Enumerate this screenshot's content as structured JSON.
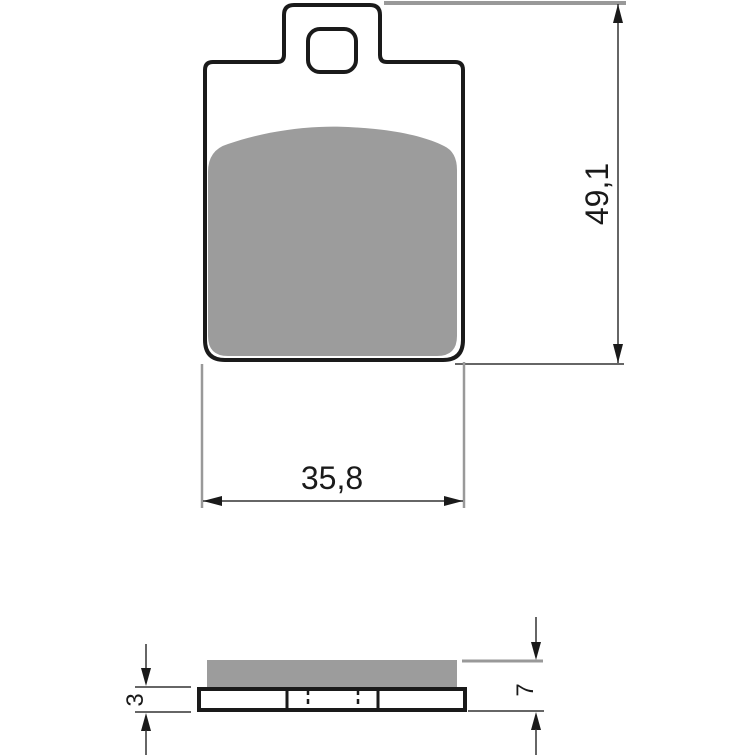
{
  "drawing": {
    "kind": "technical-dimension-drawing",
    "subject": "brake-pad",
    "views": {
      "front": "pad front profile with mounting tab and pin hole, friction material shaded gray",
      "side": "pad side profile showing friction layer over backing plate with section lines"
    }
  },
  "dimensions": {
    "width": {
      "label": "35,8"
    },
    "height": {
      "label": "49,1"
    },
    "total_thickness": {
      "label": "7"
    },
    "backplate_thickness": {
      "label": "3"
    }
  },
  "colors": {
    "background": "#ffffff",
    "outline": "#1a1a1a",
    "friction_material": "#9c9c9c",
    "extension_line_gray": "#999999",
    "dimension_line": "#333333",
    "text": "#1a1a1a"
  }
}
